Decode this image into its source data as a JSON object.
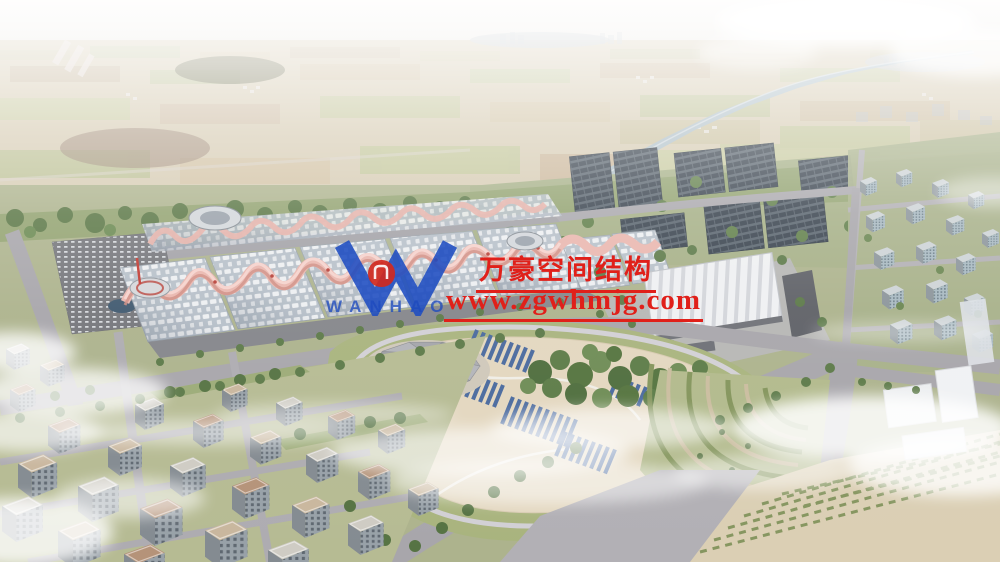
{
  "scene": {
    "description": "Hazy aerial rendering of an exhibition-center campus: wave-roofed exhibition halls with pink membrane ridges, dark rooftop solar arrays, a landscaped park with two conical canopies and rows of blue panels, mid-rise residential blocks in the foreground, farmland and a canal stretching to the horizon",
    "haze_color": "#f3f1ee",
    "roof_pink": "#e9b6ae",
    "solar_panel_color": "#39434e",
    "park_ground_color": "#e3d7bf"
  },
  "watermark": {
    "logo_icon": "wanhao-w-logo",
    "logo_text": "WANHAO",
    "company_name_cn": "万豪空间结构",
    "website": "www.zgwhmjg.com",
    "accent_red": "#e0201a",
    "accent_blue": "#1e4cc2"
  }
}
